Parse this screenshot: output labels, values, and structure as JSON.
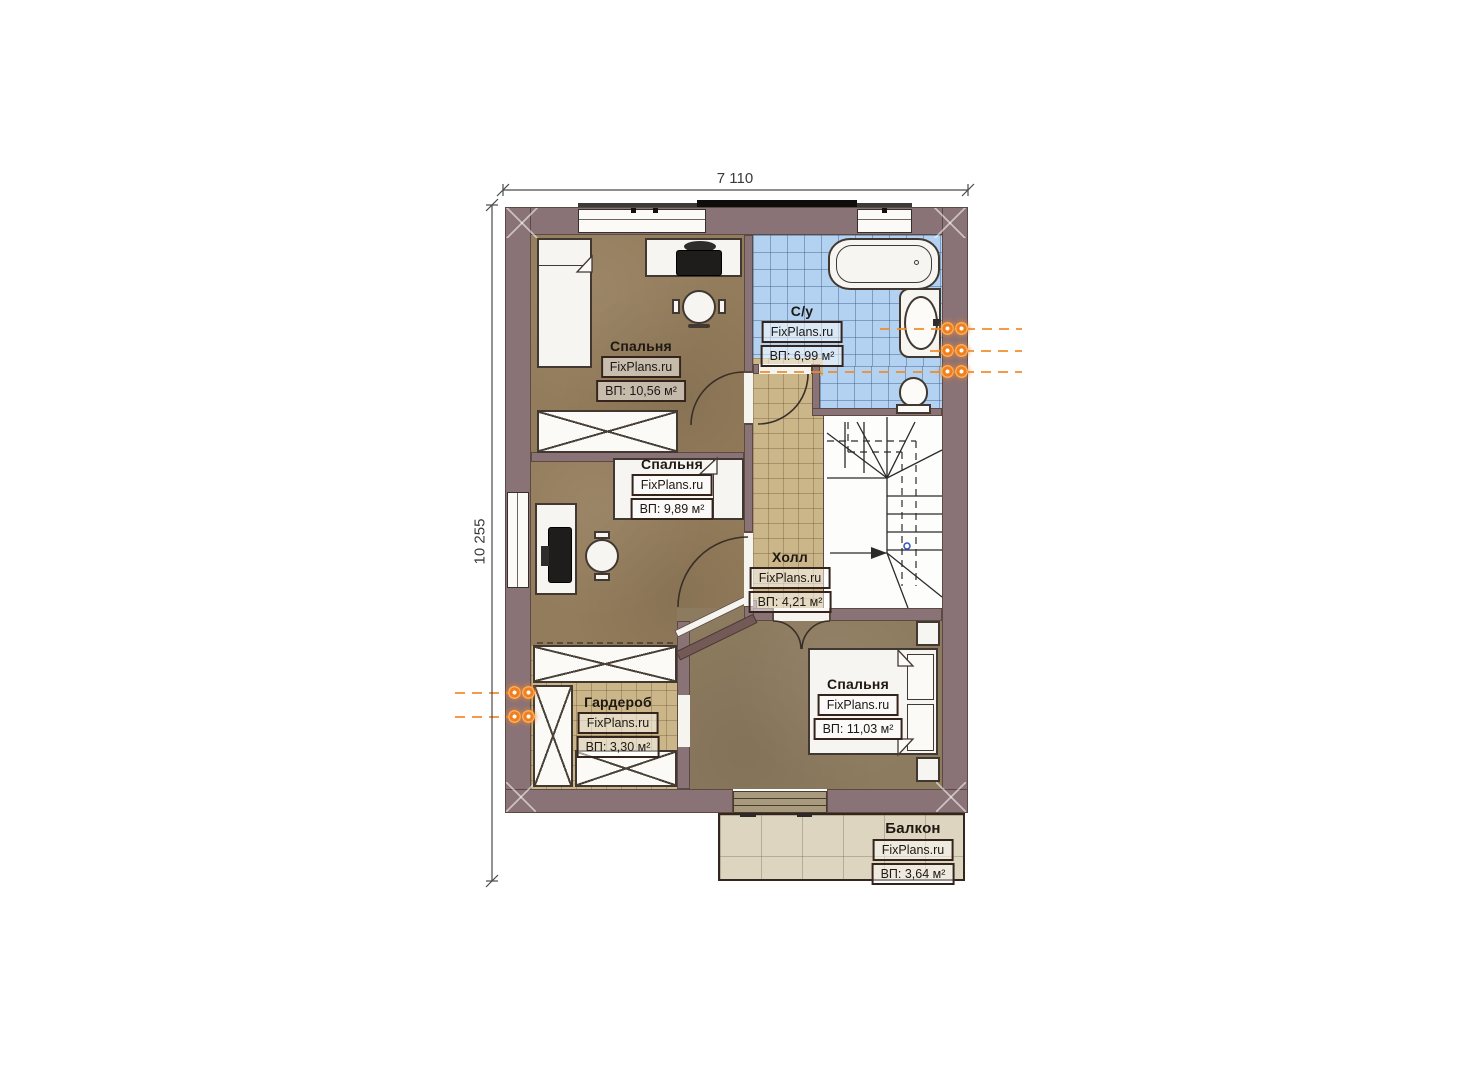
{
  "dimensions": {
    "top": "7 110",
    "left": "10 255"
  },
  "brand": "FixPlans.ru",
  "rooms": [
    {
      "key": "bedroom-top-left",
      "name": "Спальня",
      "area": "ВП: 10,56 м²"
    },
    {
      "key": "bedroom-middle-left",
      "name": "Спальня",
      "area": "ВП: 9,89 м²"
    },
    {
      "key": "bathroom",
      "name": "С/у",
      "area": "ВП: 6,99 м²"
    },
    {
      "key": "hall",
      "name": "Холл",
      "area": "ВП: 4,21 м²"
    },
    {
      "key": "bedroom-bottom-right",
      "name": "Спальня",
      "area": "ВП: 11,03 м²"
    },
    {
      "key": "wardrobe",
      "name": "Гардероб",
      "area": "ВП: 3,30 м²"
    },
    {
      "key": "balcony",
      "name": "Балкон",
      "area": "ВП: 3,64 м²"
    }
  ],
  "colors": {
    "wall": "#8a7377",
    "wood_floor": "#937c5b",
    "hall_tile": "#cbb68a",
    "bath_tile": "#b3d2f1",
    "balcony_floor": "#ded5c0",
    "utility_marker": "#f07f1f",
    "label_border": "#34241b"
  }
}
